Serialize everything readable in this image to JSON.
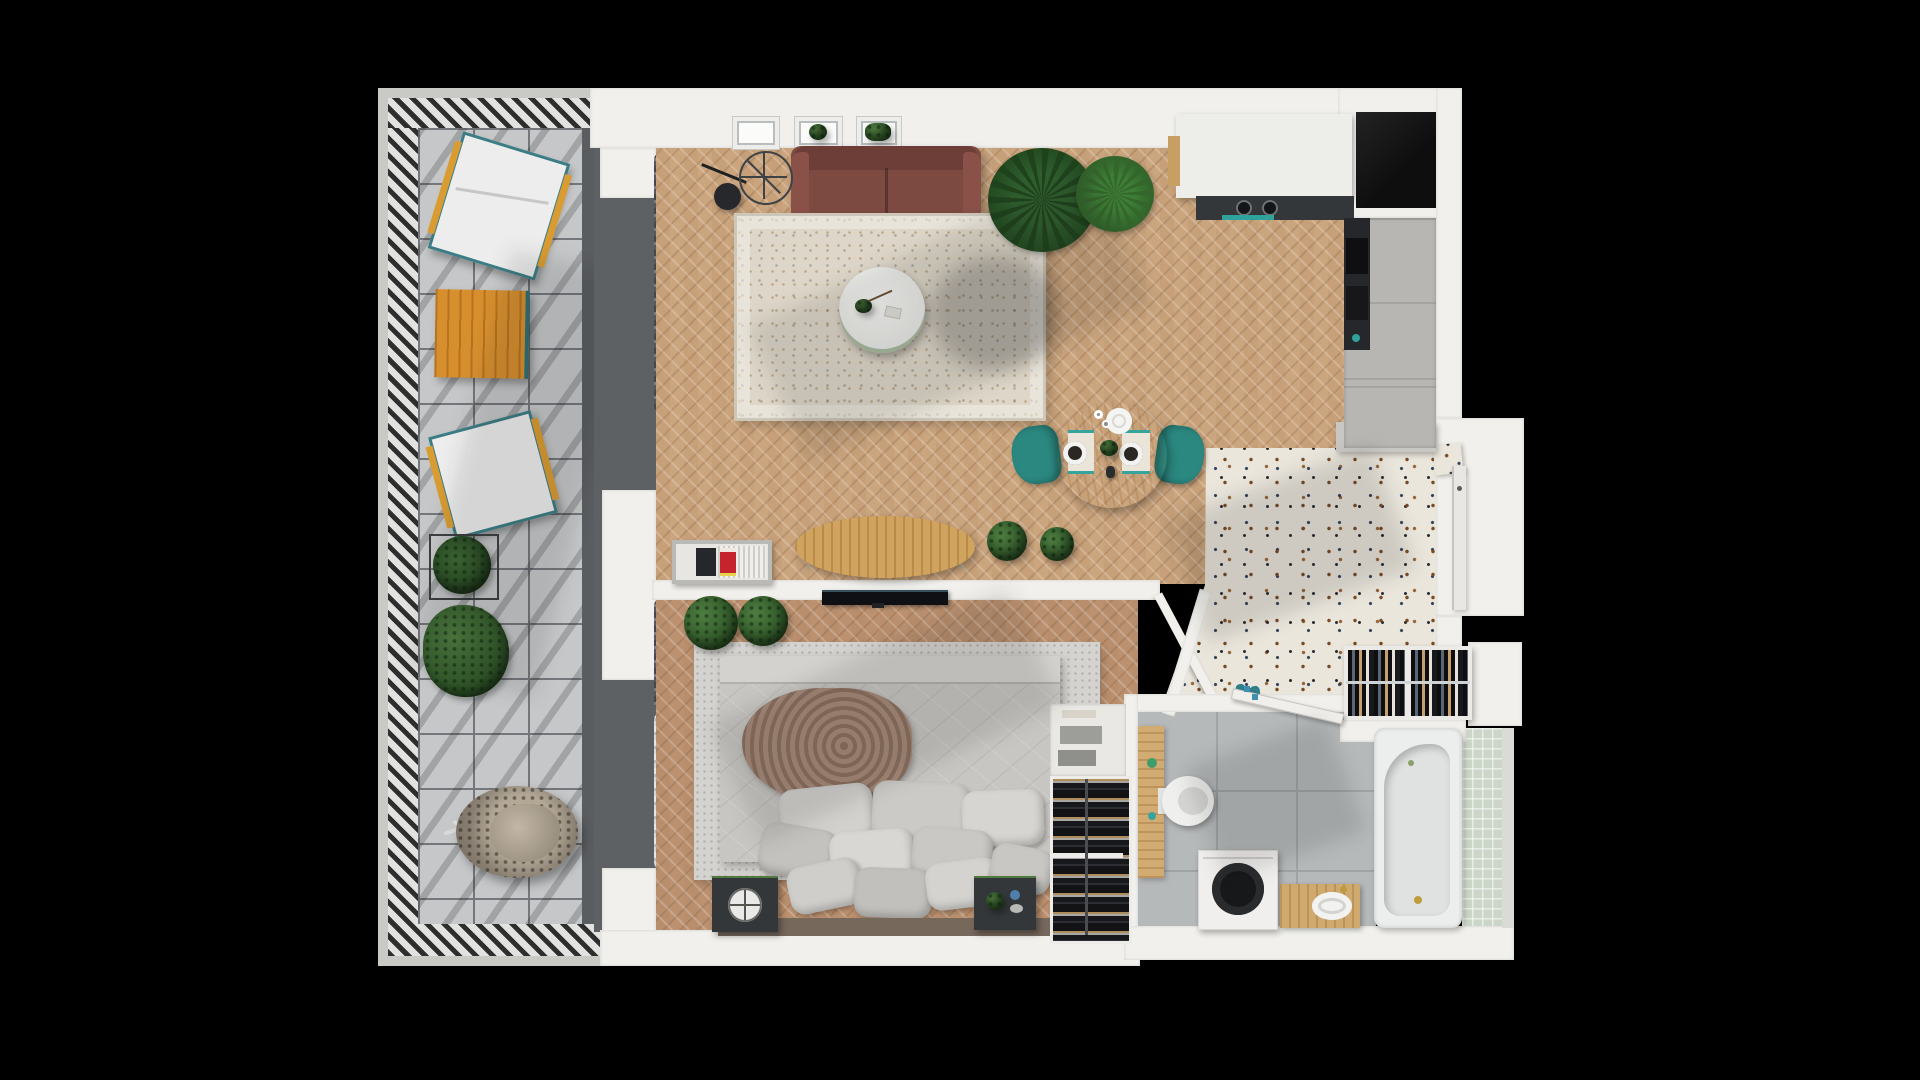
{
  "scene": {
    "kind": "3d-floor-plan-render",
    "view": "top-down",
    "background": "#000000"
  },
  "palette": {
    "wall": "#f1f0ec",
    "wood_floor": "#cba57e",
    "bedroom_floor": "#bb9170",
    "balcony_tile": "#c5c7c8",
    "terrazzo": "#eae6dc",
    "bathroom_tile": "#b6b9ba",
    "green_tile": "#ccd6c8",
    "sofa": "#7d4a42",
    "teal_accent": "#2e8c84",
    "orange_table": "#d78f2e",
    "dark_appliance": "#34373a",
    "wood_furniture": "#d0a35e"
  },
  "rooms": {
    "balcony": {
      "label": "Balcony terrace",
      "items": [
        "lounge chair",
        "lounge chair",
        "slatted orange table",
        "boxed plant",
        "leafy plant",
        "hanging egg chair",
        "ladder railing"
      ]
    },
    "living_room": {
      "label": "Living room",
      "items": [
        "maroon sofa",
        "floor lamp",
        "side table",
        "area rug",
        "round coffee table",
        "oval tv console",
        "media shelf",
        "tv",
        "palm plants",
        "window planters",
        "curtains"
      ]
    },
    "kitchen": {
      "label": "Kitchen",
      "items": [
        "island counter with cooktop",
        "teal towel",
        "tall cabinets",
        "oven column",
        "dark niche"
      ]
    },
    "dining_area": {
      "label": "Dining area",
      "items": [
        "round oak table",
        "teal chair",
        "teal chair",
        "placemats",
        "plates",
        "serving plate",
        "centerpiece plant"
      ]
    },
    "hallway": {
      "label": "Entry hall",
      "items": [
        "terrazzo floor",
        "entrance door",
        "overhead closet",
        "open wardrobe with hanging clothes",
        "shoes",
        "entry step",
        "bathroom door"
      ]
    },
    "bedroom": {
      "label": "Bedroom",
      "items": [
        "double bed",
        "duvet",
        "throw blanket",
        "pillow stack",
        "headboard",
        "nightstand with speaker",
        "nightstand with plant",
        "bed rug",
        "plants",
        "storage rack with bottles",
        "white cabinet"
      ]
    },
    "bathroom": {
      "label": "Bathroom",
      "items": [
        "wood vanity counter",
        "toilet",
        "washing machine",
        "wood sink cabinet",
        "sink",
        "bathtub",
        "green mosaic wall",
        "gold fixtures"
      ]
    }
  }
}
